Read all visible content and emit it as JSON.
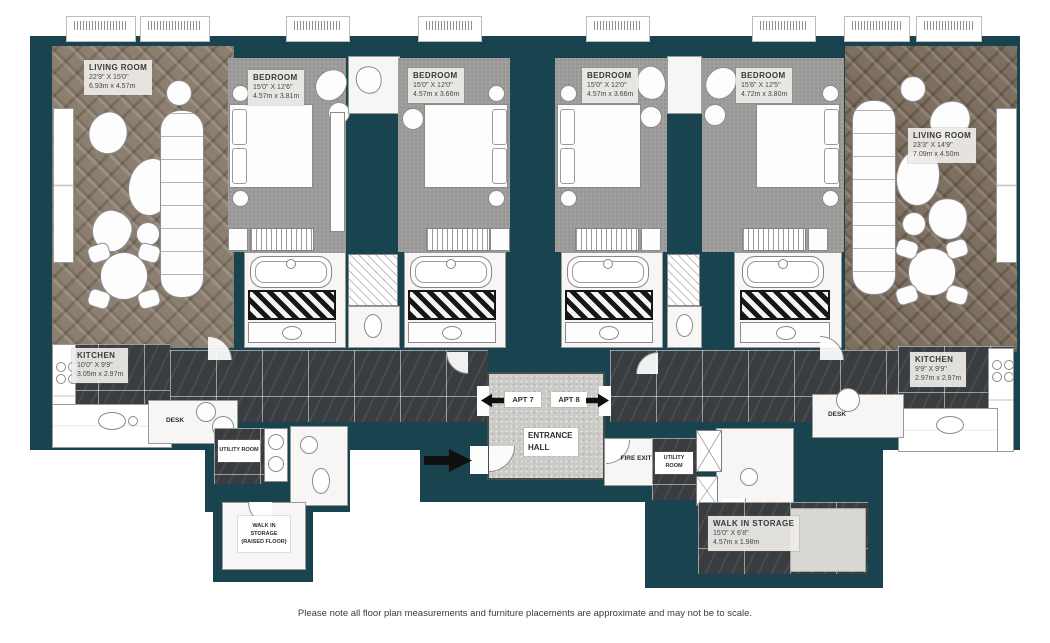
{
  "meta": {
    "footer_note": "Please note all floor plan measurements and furniture placements are approximate and may not be to scale."
  },
  "colors": {
    "background": "#ffffff",
    "walls_teal": "#18434f",
    "wood_floor": "#8c7f70",
    "carpet_gray": "#a09f9d",
    "marble_dark": "#3a3d40",
    "hall_gray": "#cbcac7",
    "arrow_black": "#101010"
  },
  "labels": {
    "living_left": {
      "name": "LIVING ROOM",
      "imperial": "22'9\" X 15'0\"",
      "metric": "6.93m x 4.57m"
    },
    "bedroom_1": {
      "name": "BEDROOM",
      "imperial": "15'0\" X 12'6\"",
      "metric": "4.57m x 3.81m"
    },
    "bedroom_2": {
      "name": "BEDROOM",
      "imperial": "15'0\" X 12'0\"",
      "metric": "4.57m x 3.66m"
    },
    "bedroom_3": {
      "name": "BEDROOM",
      "imperial": "15'0\" X 12'0\"",
      "metric": "4.57m x 3.66m"
    },
    "bedroom_4": {
      "name": "BEDROOM",
      "imperial": "15'6\" X 12'5\"",
      "metric": "4.72m x 3.80m"
    },
    "living_right": {
      "name": "LIVING ROOM",
      "imperial": "23'3\" X 14'9\"",
      "metric": "7.09m x 4.50m"
    },
    "kitchen_left": {
      "name": "KITCHEN",
      "imperial": "10'0\" X 9'9\"",
      "metric": "3.05m x 2.97m"
    },
    "kitchen_right": {
      "name": "KITCHEN",
      "imperial": "9'9\" X 9'9\"",
      "metric": "2.97m x 2.97m"
    },
    "storage_left": {
      "name": "WALK IN STORAGE",
      "note": "(RAISED FLOOR)"
    },
    "storage_right": {
      "name": "WALK IN STORAGE",
      "imperial": "15'0\" X 6'8\"",
      "metric": "4.57m x 1.98m"
    },
    "utility": "UTILITY ROOM",
    "desk": "DESK",
    "apt7": "APT 7",
    "apt8": "APT 8",
    "entrance_hall": "ENTRANCE HALL",
    "fire_exit": "FIRE EXIT"
  }
}
